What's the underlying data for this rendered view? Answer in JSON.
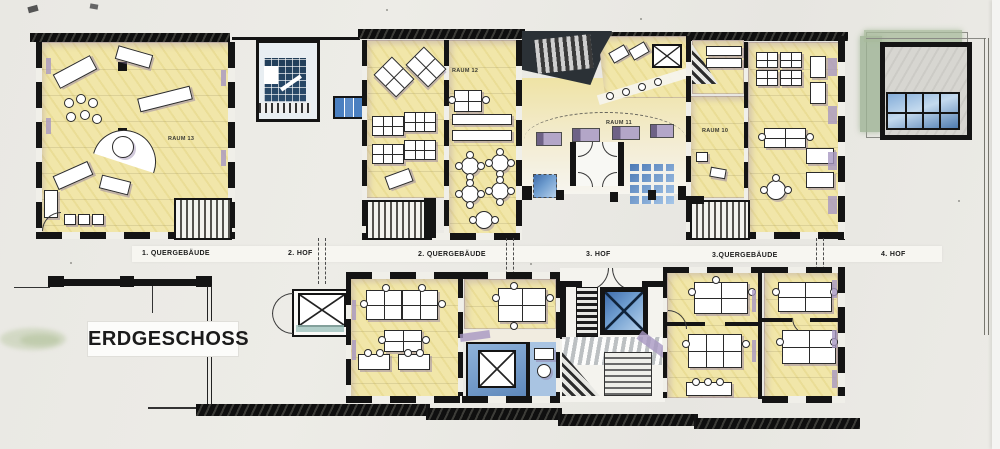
{
  "drawing": {
    "title": "ERDGESCHOSS",
    "band_labels": [
      {
        "text": "1. QUERGEBÄUDE"
      },
      {
        "text": "2. HOF"
      },
      {
        "text": "2. QUERGEBÄUDE"
      },
      {
        "text": "3. HOF"
      },
      {
        "text": "3.QUERGEBÄUDE"
      },
      {
        "text": "4. HOF"
      }
    ],
    "room_labels": [
      {
        "text": "RAUM 13"
      },
      {
        "text": "RAUM 12"
      },
      {
        "text": "RAUM 11"
      },
      {
        "text": "RAUM 10"
      }
    ],
    "colors": {
      "paper": "#e9e8e3",
      "room_yellow": "#efe4a5",
      "wall_black": "#141414",
      "accent_purple": "#a797c2",
      "water_blue": "#4f7fba",
      "glass_blue": "#9cc0e4",
      "vegetation_green": "#a8bb9c"
    }
  }
}
